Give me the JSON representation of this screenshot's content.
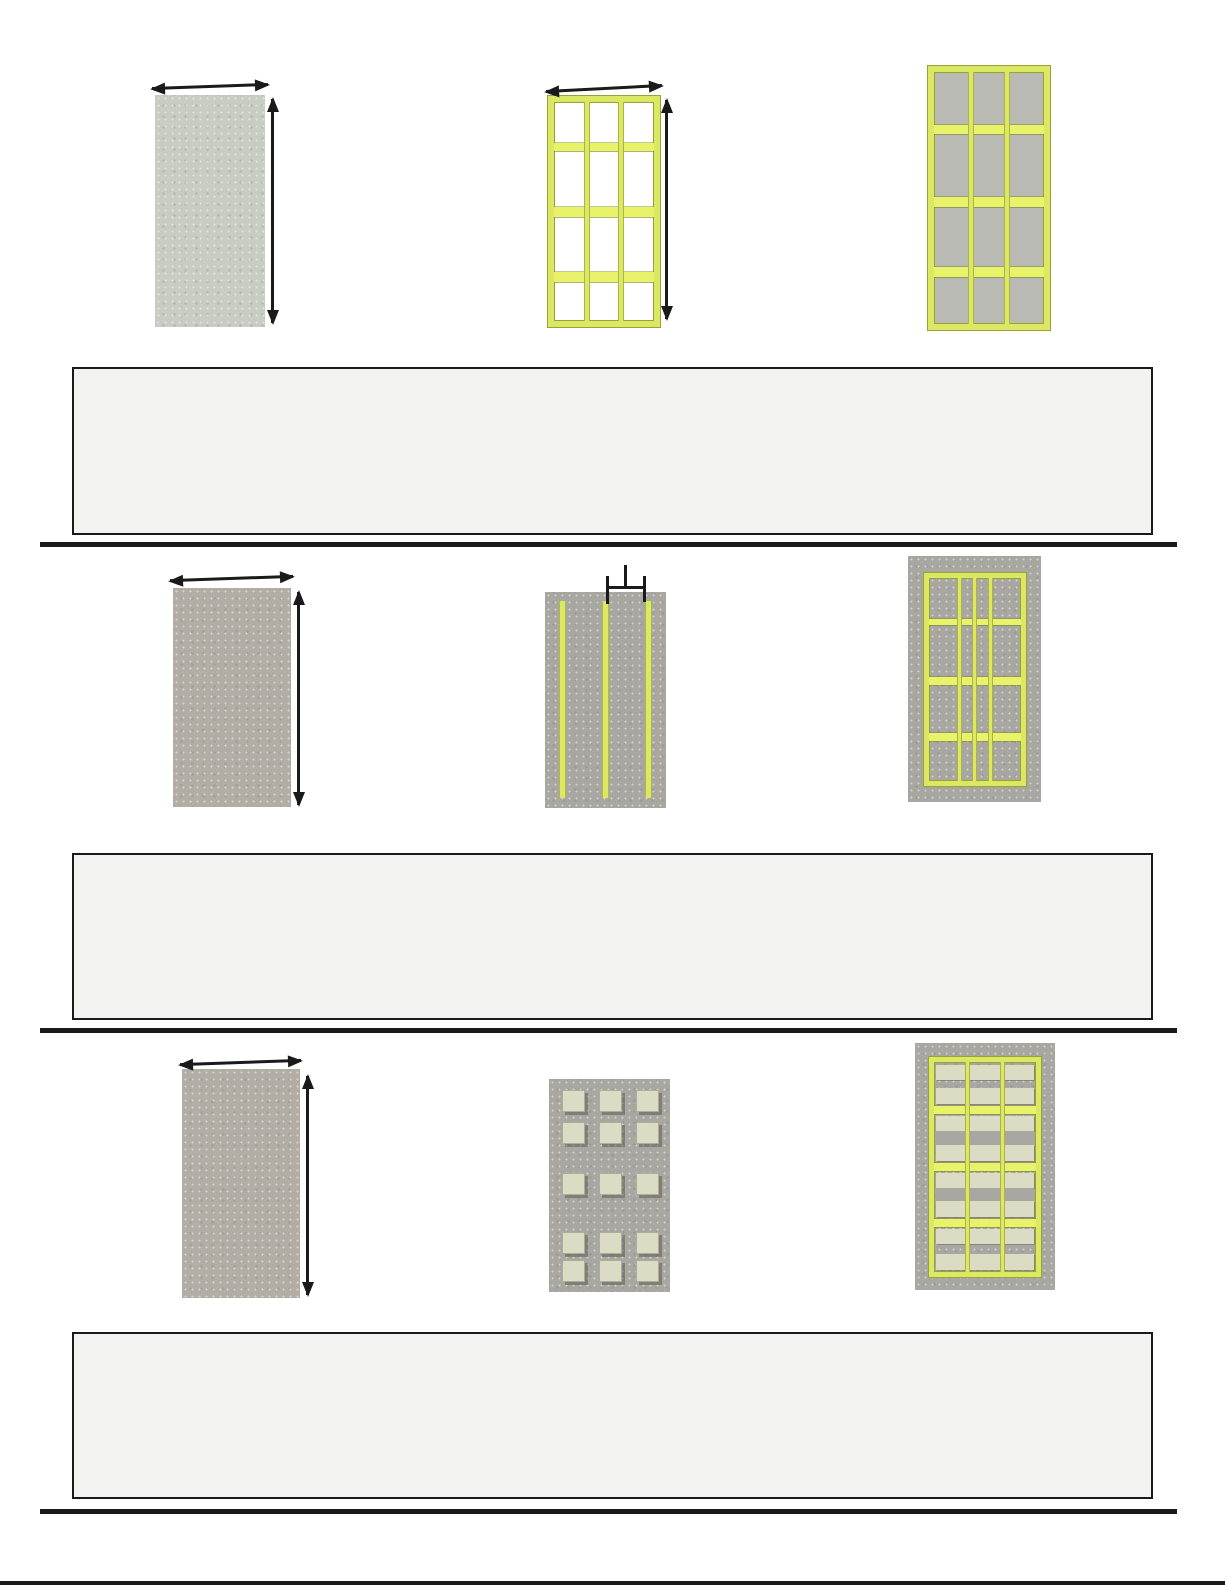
{
  "colors": {
    "frame_yellow": "#dce763",
    "frame_yellow_bright": "#e8f36a",
    "frame_outline": "#96a433",
    "panel_gray_green": "#c9ccc3",
    "panel_taupe": "#b2ada5",
    "panel_gray": "#a9a7a1",
    "sheathing_gray": "#b9bab3",
    "block_cream": "#dcdcc5",
    "answer_box_fill": "#f3f4f2",
    "ink": "#1a1a1a"
  },
  "rows": [
    {
      "figures": [
        {
          "name": "blank gray panel with width and height dimension arrows",
          "icons": [
            "width-arrow-icon",
            "height-arrow-icon"
          ]
        },
        {
          "name": "empty yellow stud-wall frame with width and height dimension arrows",
          "icons": [
            "width-arrow-icon",
            "height-arrow-icon"
          ]
        },
        {
          "name": "yellow stud-wall frame sheathed with gray panels",
          "icons": []
        }
      ]
    },
    {
      "figures": [
        {
          "name": "blank gray panel with width and height dimension arrows",
          "icons": [
            "width-arrow-icon",
            "height-arrow-icon"
          ]
        },
        {
          "name": "gray panel with three vertical yellow studs and stud-spacing mark",
          "icons": [
            "stud-spacing-mark-icon"
          ]
        },
        {
          "name": "yellow stud-wall frame drawn over gray panel",
          "icons": []
        }
      ]
    },
    {
      "figures": [
        {
          "name": "blank gray panel with width and height dimension arrows",
          "icons": [
            "width-arrow-icon",
            "height-arrow-icon"
          ]
        },
        {
          "name": "gray panel with grid of cream square cutouts",
          "icons": []
        },
        {
          "name": "yellow stud-wall frame over gray panel with cream blocking pieces",
          "icons": []
        }
      ]
    }
  ],
  "answer_boxes": [
    {
      "value": ""
    },
    {
      "value": ""
    },
    {
      "value": ""
    }
  ]
}
